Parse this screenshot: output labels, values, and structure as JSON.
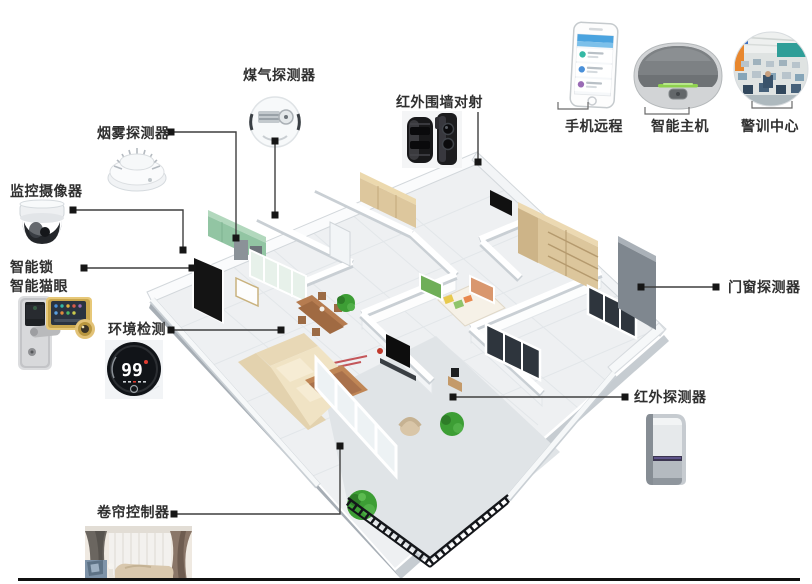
{
  "callouts": {
    "gas": {
      "label": "煤气探测器",
      "icon": "gas-detector-icon"
    },
    "smoke": {
      "label": "烟雾探测器",
      "icon": "smoke-detector-icon"
    },
    "camera": {
      "label": "监控摄像器",
      "icon": "dome-camera-icon"
    },
    "lock": {
      "label1": "智能锁",
      "label2": "智能猫眼",
      "icon": "smart-lock-icon"
    },
    "env": {
      "label": "环境检测",
      "value": "99",
      "icon": "thermostat-icon"
    },
    "shutter": {
      "label": "卷帘控制器",
      "icon": "curtain-room-photo"
    },
    "beam": {
      "label": "红外围墙对射",
      "icon": "perimeter-beam-icon"
    },
    "phone": {
      "label": "手机远程",
      "icon": "smartphone-icon"
    },
    "host": {
      "label": "智能主机",
      "icon": "smart-hub-icon"
    },
    "alarm": {
      "label": "警训中心",
      "icon": "monitoring-room-photo"
    },
    "door_window": {
      "label": "门窗探测器"
    },
    "pir": {
      "label": "红外探测器",
      "icon": "pir-sensor-icon"
    }
  },
  "colors": {
    "label_text": "#2f2f2f",
    "connector_line": "#3f3f3f",
    "marker": "#161616",
    "cabinet_green": "#92c5a3",
    "wood": "#b07a4e",
    "sofa_beige": "#ead9b8",
    "plant_green": "#3d9e35",
    "host_led_green": "#8fd14f",
    "bottom_rule": "#111111"
  }
}
